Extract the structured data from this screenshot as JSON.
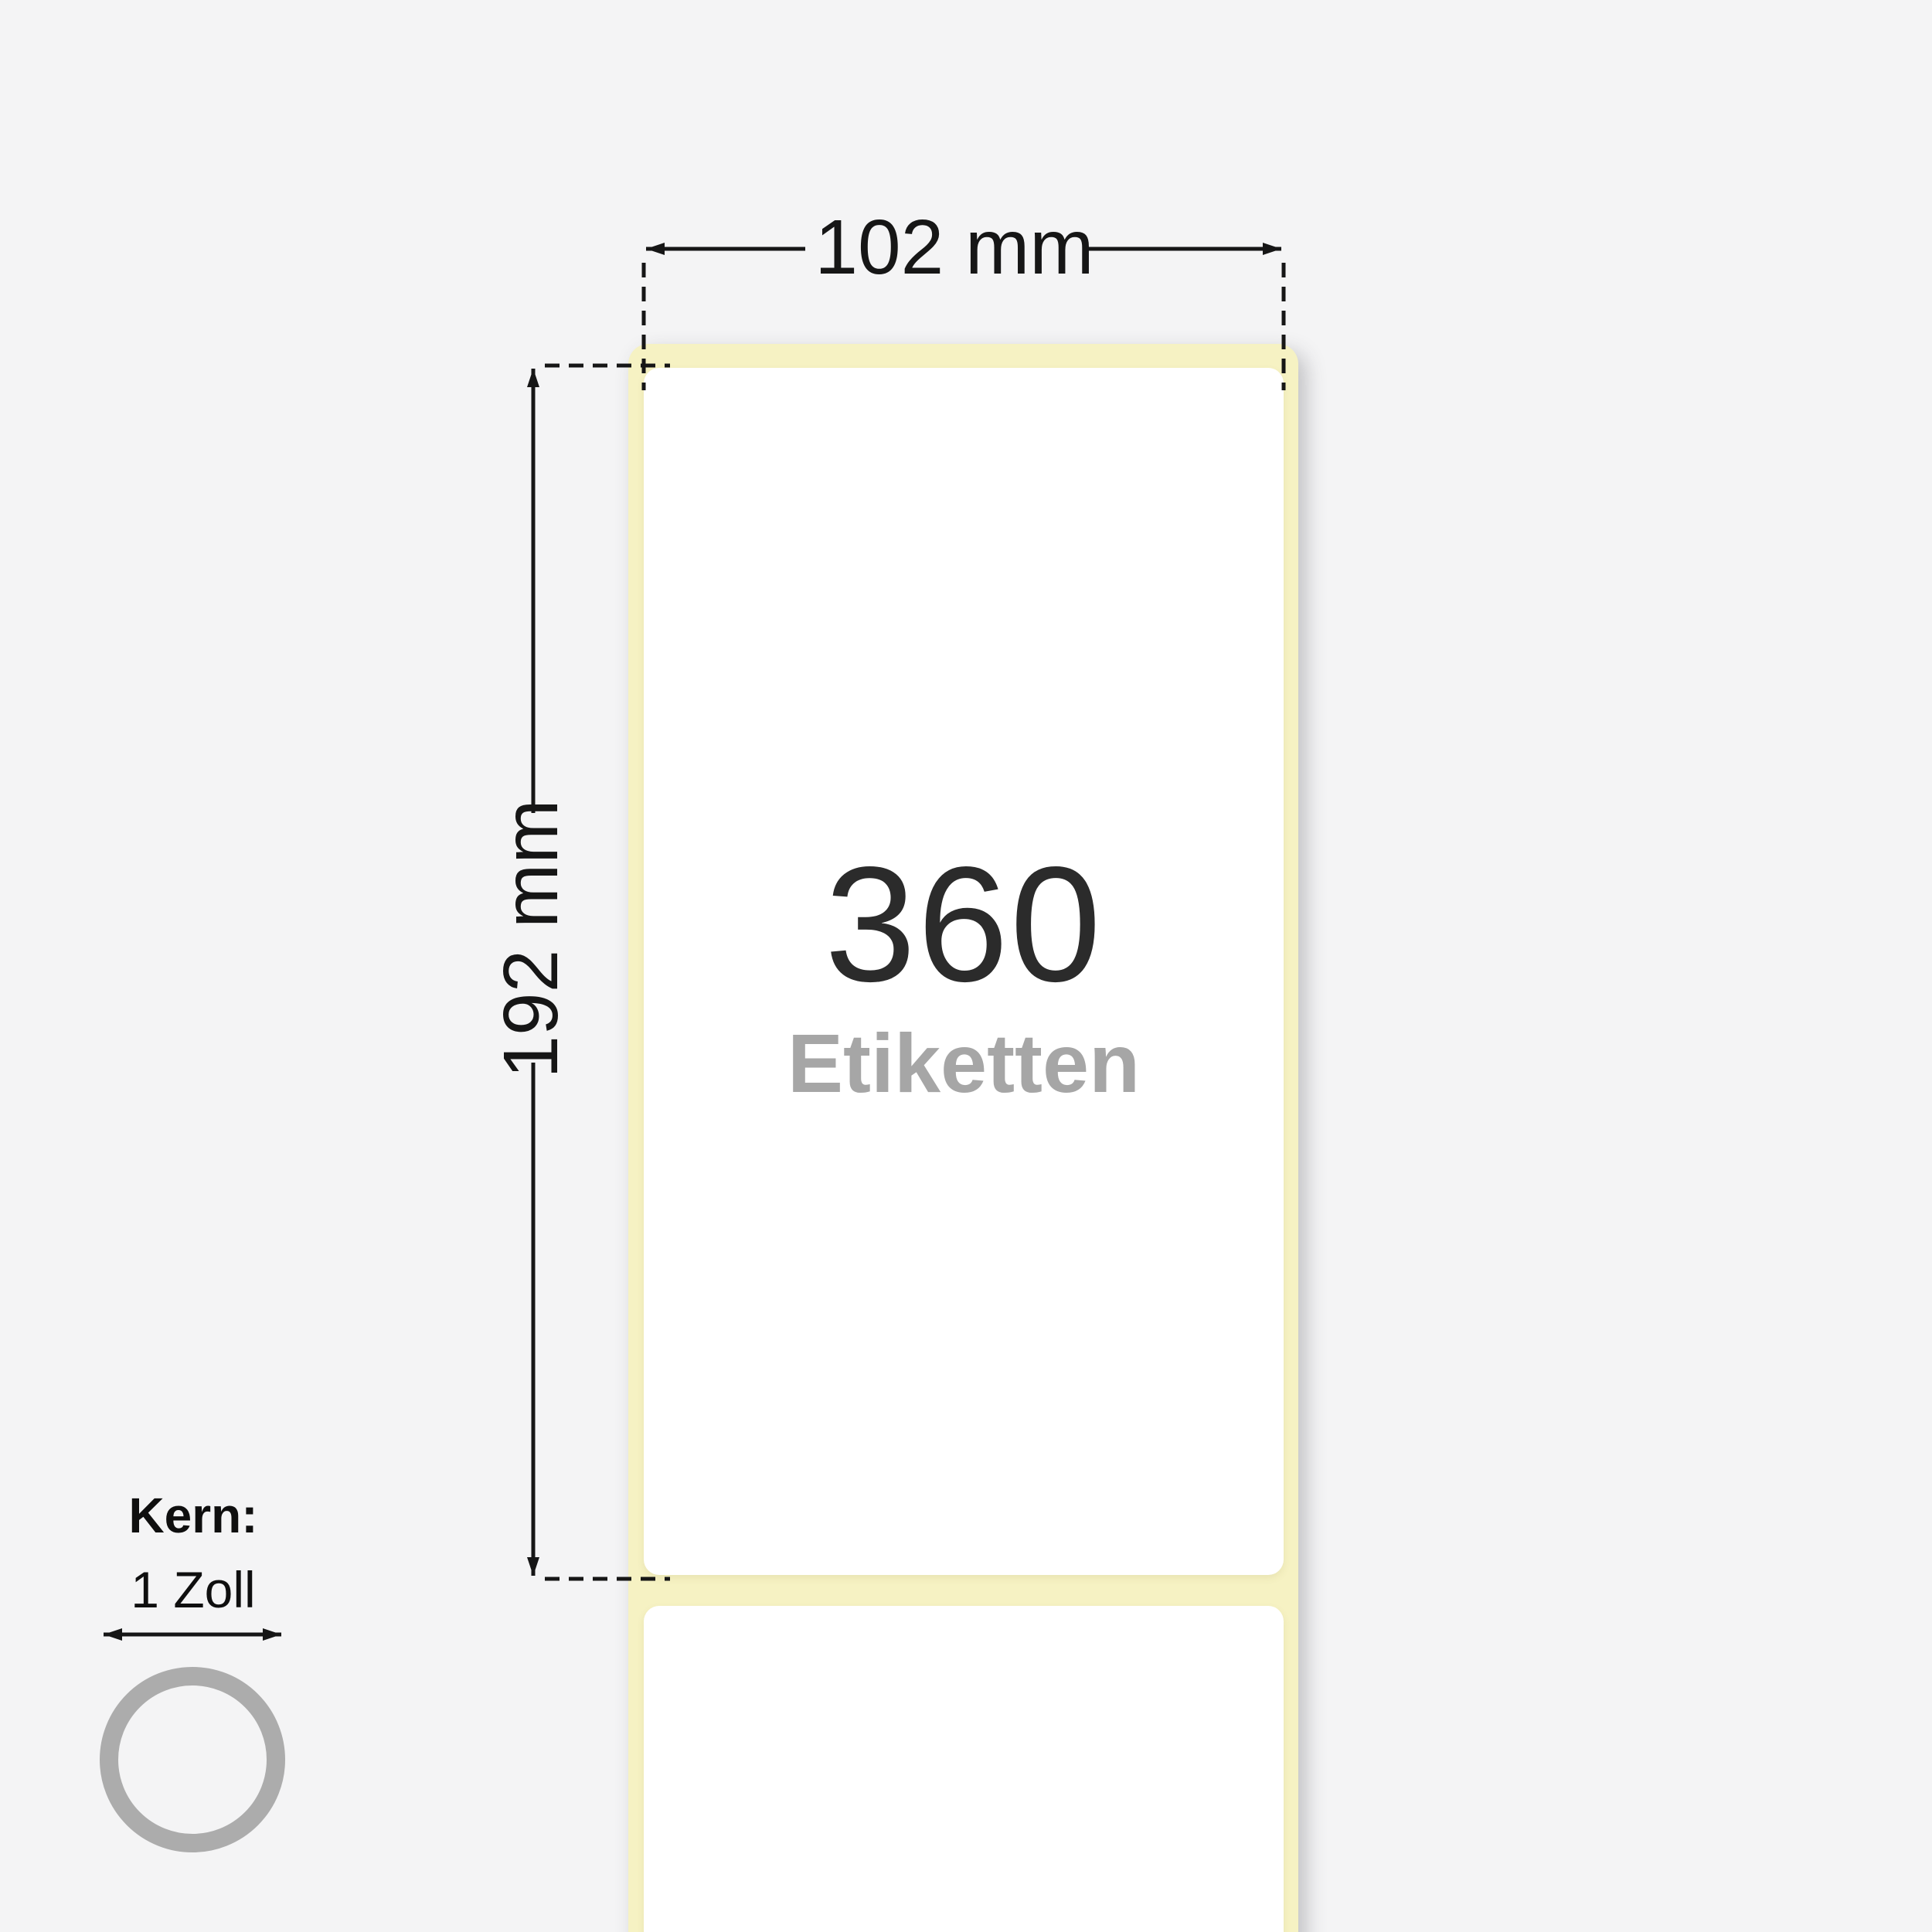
{
  "diagram": {
    "type": "label-roll-dimension-diagram",
    "dimensions": {
      "width_label": "102 mm",
      "height_label": "192 mm"
    },
    "roll": {
      "count": "360",
      "count_unit": "Etiketten"
    },
    "core": {
      "title": "Kern:",
      "value": "1 Zoll"
    },
    "colors": {
      "background": "#f4f4f5",
      "liner_yellow": "#f6f2c3",
      "label_white": "#ffffff",
      "count_text": "#2b2b2b",
      "unit_text": "#a6a6a6",
      "dimension_ink": "#161616",
      "core_ring_gray": "#acacac"
    }
  }
}
